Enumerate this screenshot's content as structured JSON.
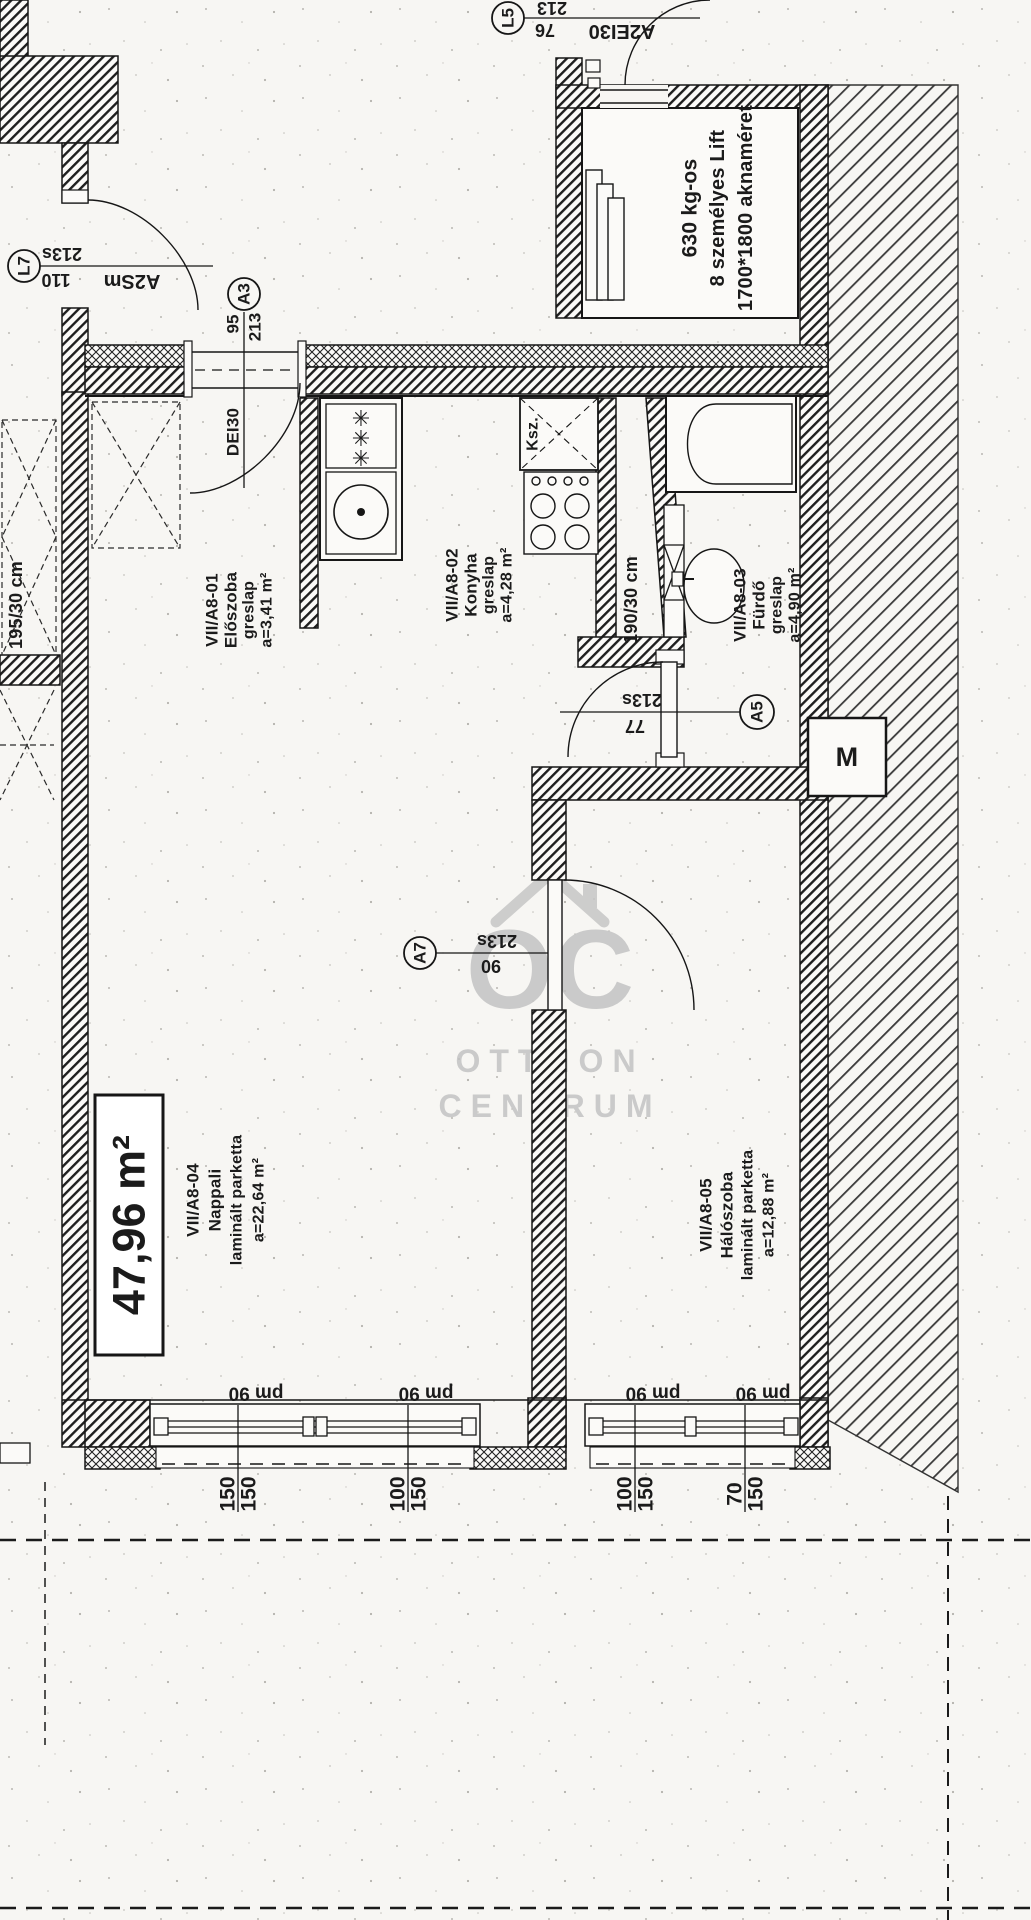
{
  "markers": {
    "l5": {
      "id": "L5",
      "dim_top": "213",
      "dim_bottom": "76",
      "door_code": "A2EI30"
    },
    "l7": {
      "id": "L7",
      "dim_top": "213s",
      "dim_bottom": "110",
      "door_code": "A2Sm"
    },
    "a3": {
      "id": "A3",
      "dim_left": "95",
      "dim_right": "213"
    },
    "a5": {
      "id": "A5",
      "dim_top": "213s",
      "dim_bottom": "77"
    },
    "a7": {
      "id": "A7",
      "dim_top": "213s",
      "dim_bottom": "90"
    }
  },
  "lift": {
    "line1": "630 kg-os",
    "line2": "8 személyes Lift",
    "line3": "1700*1800 aknaméret"
  },
  "entry_door_label": "DEI30",
  "shaft_label": "Ksz.",
  "radiator_left": "195/30 cm",
  "radiator_bath": "190/30 cm",
  "meter_label": "M",
  "total_area": "47,96 m²",
  "rooms": [
    {
      "id": "VII/A8-01",
      "name": "Előszoba",
      "floor": "greslap",
      "area": "a=3,41 m²"
    },
    {
      "id": "VII/A8-02",
      "name": "Konyha",
      "floor": "greslap",
      "area": "a=4,28 m²"
    },
    {
      "id": "VII/A8-03",
      "name": "Fürdő",
      "floor": "greslap",
      "area": "a=4,90 m²"
    },
    {
      "id": "VII/A8-04",
      "name": "Nappali",
      "floor": "laminált parketta",
      "area": "a=22,64 m²"
    },
    {
      "id": "VII/A8-05",
      "name": "Hálószoba",
      "floor": "laminált parketta",
      "area": "a=12,88 m²"
    }
  ],
  "windows": {
    "parapet_label": "pm 90",
    "markers": [
      {
        "left": "150",
        "right": "150"
      },
      {
        "left": "100",
        "right": "150"
      },
      {
        "left": "100",
        "right": "150"
      },
      {
        "left": "70",
        "right": "150"
      }
    ]
  },
  "watermark": {
    "logo": "OC",
    "line1": "OTTHON",
    "line2": "CENTRUM"
  }
}
